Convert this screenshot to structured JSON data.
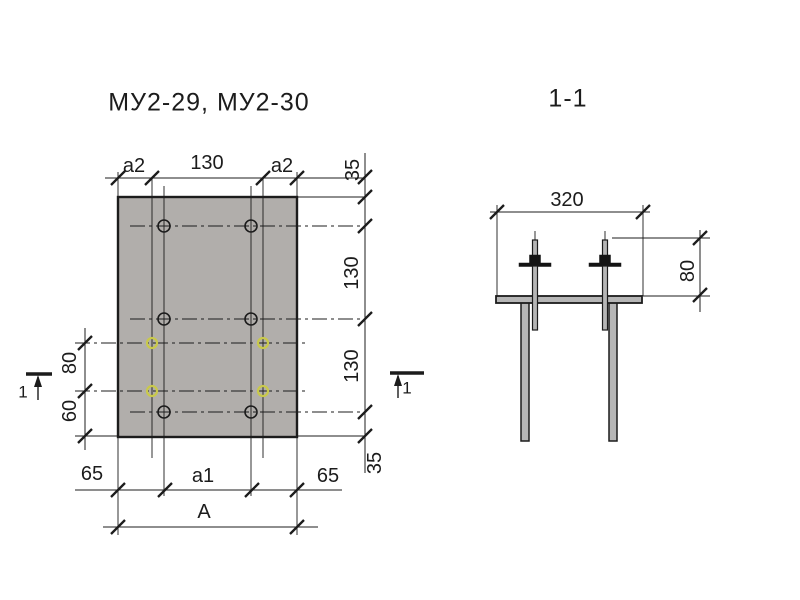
{
  "colors": {
    "bg": "#ffffff",
    "line": "#1c1c1c",
    "plate": "#b1aeab",
    "metal": "#b6b6b6",
    "dark": "#141414",
    "highlight": "#c9c94a"
  },
  "labels": {
    "plan_title": "МУ2-29, МУ2-30",
    "section_title": "1-1",
    "dim_a2_left": "a2",
    "dim_130_top": "130",
    "dim_a2_right": "a2",
    "dim_35_top": "35",
    "dim_130_right_upper": "130",
    "dim_130_right_lower": "130",
    "dim_35_bottom": "35",
    "dim_80_left": "80",
    "dim_60_left": "60",
    "dim_65_left": "65",
    "dim_a1": "a1",
    "dim_65_right": "65",
    "dim_A": "A",
    "dim_320": "320",
    "dim_80_section": "80",
    "cut_label_left": "1",
    "cut_label_right": "1"
  }
}
